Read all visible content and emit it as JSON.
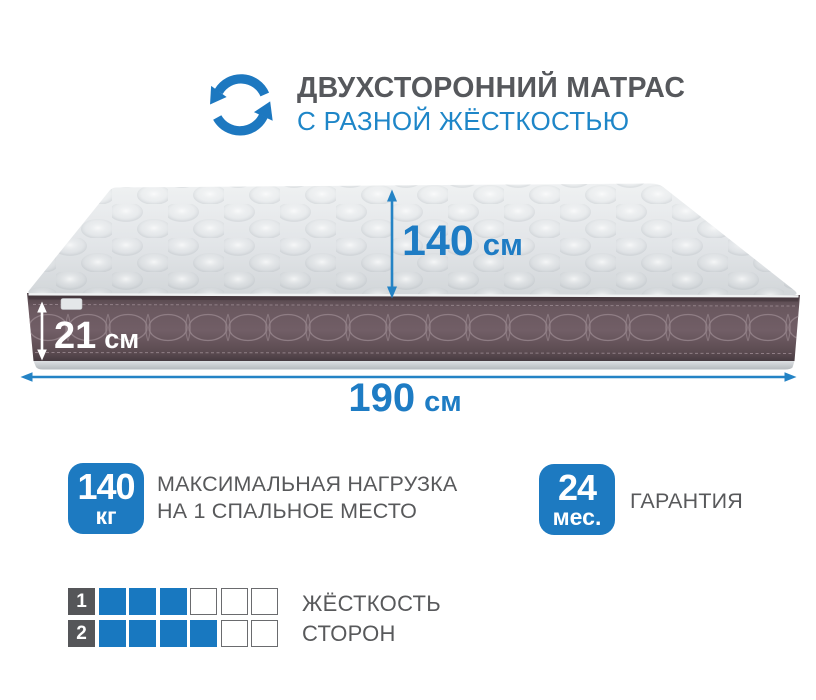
{
  "colors": {
    "accent_blue": "#1e7cc4",
    "subtitle_blue": "#1e86c8",
    "text_gray": "#58595b",
    "title_gray": "#56585c",
    "mattress_side": "#6e5c63",
    "mattress_top": "#e7eaec",
    "filled_square": "#1878c0",
    "number_square": "#555659"
  },
  "header": {
    "title": "ДВУХСТОРОННИЙ МАТРАС",
    "subtitle": "С РАЗНОЙ ЖЁСТКОСТЬЮ",
    "icon": "rotate-arrows-icon"
  },
  "dimensions": {
    "width": {
      "value": "140",
      "unit": "см"
    },
    "height": {
      "value": "21",
      "unit": "см"
    },
    "length": {
      "value": "190",
      "unit": "см"
    }
  },
  "features": [
    {
      "badge_value": "140",
      "badge_unit": "кг",
      "label_line1": "МАКСИМАЛЬНАЯ НАГРУЗКА",
      "label_line2": "НА 1 СПАЛЬНОЕ МЕСТО"
    },
    {
      "badge_value": "24",
      "badge_unit": "мес.",
      "label_line1": "ГАРАНТИЯ",
      "label_line2": ""
    }
  ],
  "firmness": {
    "label_line1": "ЖЁСТКОСТЬ",
    "label_line2": "СТОРОН",
    "rows": [
      {
        "side": "1",
        "filled": 3,
        "total": 6
      },
      {
        "side": "2",
        "filled": 4,
        "total": 6
      }
    ]
  }
}
